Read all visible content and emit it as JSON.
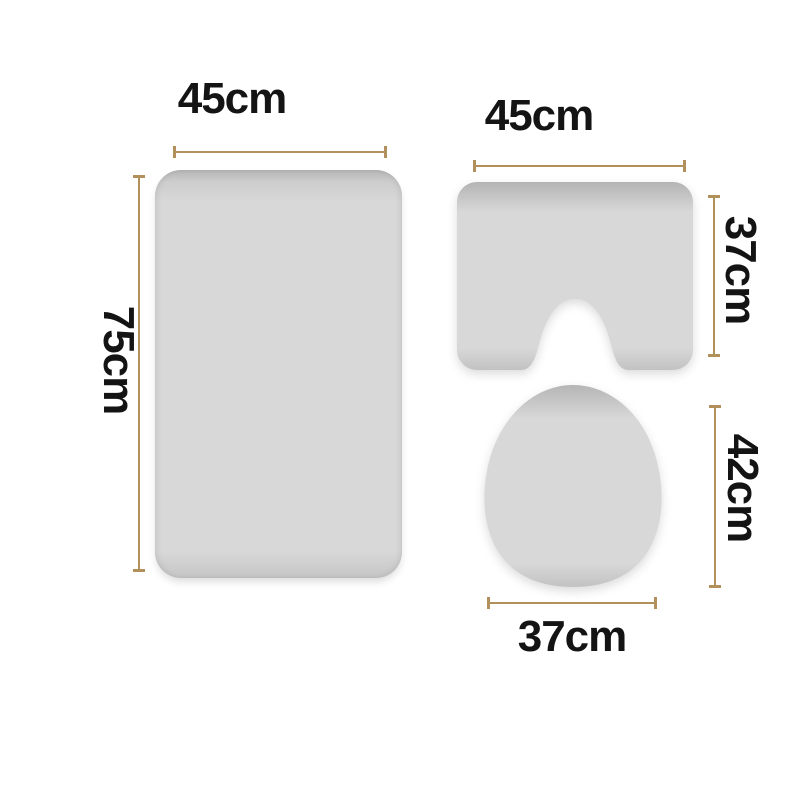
{
  "diagram": {
    "items": [
      {
        "id": "bath-mat",
        "width_label": "45cm",
        "height_label": "75cm"
      },
      {
        "id": "contour-mat",
        "width_label": "45cm",
        "height_label": "37cm"
      },
      {
        "id": "lid-cover",
        "width_label": "37cm",
        "height_label": "42cm"
      }
    ],
    "colors": {
      "arrow": "#b1905c",
      "text": "#141414",
      "mat_fill": "#d8d8d8",
      "background": "#ffffff"
    }
  }
}
